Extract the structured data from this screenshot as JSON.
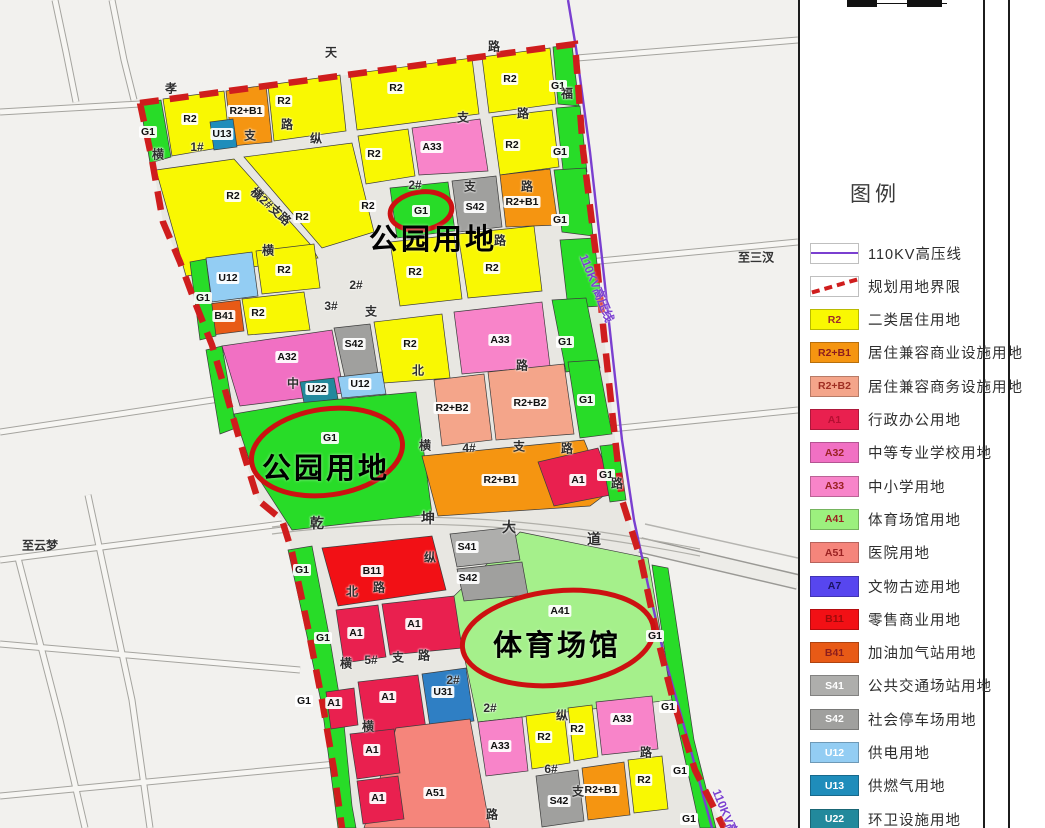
{
  "legend": {
    "title": "图例",
    "items": [
      {
        "type": "line110",
        "code": "",
        "label": "110KV高压线"
      },
      {
        "type": "dash",
        "code": "",
        "label": "规划用地界限"
      },
      {
        "type": "fill",
        "code": "R2",
        "color": "#f9f802",
        "code_color": "#9e2b2b",
        "label": "二类居住用地"
      },
      {
        "type": "fill",
        "code": "R2+B1",
        "color": "#f59511",
        "code_color": "#8d1d1d",
        "label": "居住兼容商业设施用地"
      },
      {
        "type": "fill",
        "code": "R2+B2",
        "color": "#f4a58a",
        "code_color": "#a03024",
        "label": "居住兼容商务设施用地"
      },
      {
        "type": "fill",
        "code": "A1",
        "color": "#e9204f",
        "code_color": "#b50f32",
        "label": "行政办公用地"
      },
      {
        "type": "fill",
        "code": "A32",
        "color": "#f170c3",
        "code_color": "#9b2222",
        "label": "中等专业学校用地"
      },
      {
        "type": "fill",
        "code": "A33",
        "color": "#f884c9",
        "code_color": "#9b2222",
        "label": "中小学用地"
      },
      {
        "type": "fill",
        "code": "A41",
        "color": "#9cf07e",
        "code_color": "#9b2222",
        "label": "体育场馆用地"
      },
      {
        "type": "fill",
        "code": "A51",
        "color": "#f5857b",
        "code_color": "#9b2222",
        "label": "医院用地"
      },
      {
        "type": "fill",
        "code": "A7",
        "color": "#5746ef",
        "code_color": "#1b1464",
        "label": "文物古迹用地"
      },
      {
        "type": "fill",
        "code": "B11",
        "color": "#f21015",
        "code_color": "#9e0a0a",
        "label": "零售商业用地"
      },
      {
        "type": "fill",
        "code": "B41",
        "color": "#e85a16",
        "code_color": "#8d1d1d",
        "label": "加油加气站用地"
      },
      {
        "type": "fill",
        "code": "S41",
        "color": "#aeaeac",
        "code_color": "#ffffff",
        "label": "公共交通场站用地"
      },
      {
        "type": "fill",
        "code": "S42",
        "color": "#a0a09e",
        "code_color": "#ffffff",
        "label": "社会停车场用地"
      },
      {
        "type": "fill",
        "code": "U12",
        "color": "#93cdf3",
        "code_color": "#ffffff",
        "label": "供电用地"
      },
      {
        "type": "fill",
        "code": "U13",
        "color": "#1f8dbb",
        "code_color": "#ffffff",
        "label": "供燃气用地"
      },
      {
        "type": "fill",
        "code": "U22",
        "color": "#22899c",
        "code_color": "#ffffff",
        "label": "环卫设施用地"
      }
    ]
  },
  "map": {
    "boundary_color": "#cf1d1d",
    "power_line_color": "#7a3fd0",
    "annotations": [
      {
        "t": "公园用地",
        "x": 433,
        "y": 237
      },
      {
        "t": "公园用地",
        "x": 326,
        "y": 466
      },
      {
        "t": "体育场馆",
        "x": 557,
        "y": 643
      }
    ],
    "notes": [
      {
        "t": "至云梦",
        "x": 40,
        "y": 545
      },
      {
        "t": "至三汊",
        "x": 756,
        "y": 257
      },
      {
        "t": "110KV高压线",
        "x": 597,
        "y": 288,
        "r": 68,
        "c": "#7a3fd0"
      },
      {
        "t": "110KV高压线",
        "x": 730,
        "y": 823,
        "r": 68,
        "c": "#7a3fd0"
      }
    ],
    "parcel_labels": [
      {
        "t": "G1",
        "x": 148,
        "y": 132
      },
      {
        "t": "R2",
        "x": 190,
        "y": 119
      },
      {
        "t": "U13",
        "x": 222,
        "y": 134
      },
      {
        "t": "R2+B1",
        "x": 246,
        "y": 111
      },
      {
        "t": "R2",
        "x": 284,
        "y": 101
      },
      {
        "t": "R2",
        "x": 396,
        "y": 88
      },
      {
        "t": "R2",
        "x": 510,
        "y": 79
      },
      {
        "t": "G1",
        "x": 558,
        "y": 86
      },
      {
        "t": "R2",
        "x": 233,
        "y": 196
      },
      {
        "t": "R2",
        "x": 302,
        "y": 217
      },
      {
        "t": "R2",
        "x": 368,
        "y": 206
      },
      {
        "t": "R2",
        "x": 374,
        "y": 154
      },
      {
        "t": "A33",
        "x": 432,
        "y": 147
      },
      {
        "t": "R2",
        "x": 512,
        "y": 145
      },
      {
        "t": "G1",
        "x": 560,
        "y": 152
      },
      {
        "t": "G1",
        "x": 421,
        "y": 211
      },
      {
        "t": "S42",
        "x": 475,
        "y": 207
      },
      {
        "t": "R2+B1",
        "x": 522,
        "y": 202
      },
      {
        "t": "G1",
        "x": 560,
        "y": 220
      },
      {
        "t": "U12",
        "x": 228,
        "y": 278
      },
      {
        "t": "R2",
        "x": 284,
        "y": 270
      },
      {
        "t": "B41",
        "x": 224,
        "y": 316
      },
      {
        "t": "R2",
        "x": 258,
        "y": 313
      },
      {
        "t": "G1",
        "x": 203,
        "y": 298
      },
      {
        "t": "R2",
        "x": 415,
        "y": 272
      },
      {
        "t": "R2",
        "x": 492,
        "y": 268
      },
      {
        "t": "A32",
        "x": 287,
        "y": 357
      },
      {
        "t": "S42",
        "x": 354,
        "y": 344
      },
      {
        "t": "R2",
        "x": 410,
        "y": 344
      },
      {
        "t": "A33",
        "x": 500,
        "y": 340
      },
      {
        "t": "G1",
        "x": 565,
        "y": 342
      },
      {
        "t": "U22",
        "x": 317,
        "y": 389
      },
      {
        "t": "U12",
        "x": 360,
        "y": 384
      },
      {
        "t": "G1",
        "x": 330,
        "y": 438
      },
      {
        "t": "R2+B2",
        "x": 452,
        "y": 408
      },
      {
        "t": "R2+B2",
        "x": 530,
        "y": 403
      },
      {
        "t": "G1",
        "x": 586,
        "y": 400
      },
      {
        "t": "R2+B1",
        "x": 500,
        "y": 480
      },
      {
        "t": "A1",
        "x": 578,
        "y": 480
      },
      {
        "t": "G1",
        "x": 606,
        "y": 475
      },
      {
        "t": "G1",
        "x": 302,
        "y": 570
      },
      {
        "t": "B11",
        "x": 372,
        "y": 571
      },
      {
        "t": "S41",
        "x": 467,
        "y": 547
      },
      {
        "t": "S42",
        "x": 468,
        "y": 578
      },
      {
        "t": "A41",
        "x": 560,
        "y": 611
      },
      {
        "t": "G1",
        "x": 323,
        "y": 638
      },
      {
        "t": "A1",
        "x": 356,
        "y": 633
      },
      {
        "t": "A1",
        "x": 414,
        "y": 624
      },
      {
        "t": "G1",
        "x": 304,
        "y": 701
      },
      {
        "t": "A1",
        "x": 334,
        "y": 703
      },
      {
        "t": "A1",
        "x": 388,
        "y": 697
      },
      {
        "t": "U31",
        "x": 443,
        "y": 692
      },
      {
        "t": "A1",
        "x": 372,
        "y": 750
      },
      {
        "t": "A1",
        "x": 378,
        "y": 798
      },
      {
        "t": "A51",
        "x": 435,
        "y": 793
      },
      {
        "t": "A33",
        "x": 500,
        "y": 746
      },
      {
        "t": "R2",
        "x": 544,
        "y": 737
      },
      {
        "t": "R2",
        "x": 577,
        "y": 729
      },
      {
        "t": "A33",
        "x": 622,
        "y": 719
      },
      {
        "t": "G1",
        "x": 655,
        "y": 636
      },
      {
        "t": "G1",
        "x": 668,
        "y": 707
      },
      {
        "t": "G1",
        "x": 680,
        "y": 771
      },
      {
        "t": "G1",
        "x": 689,
        "y": 819
      },
      {
        "t": "S42",
        "x": 559,
        "y": 801
      },
      {
        "t": "R2+B1",
        "x": 601,
        "y": 790
      },
      {
        "t": "R2",
        "x": 644,
        "y": 780
      }
    ],
    "road_labels": [
      {
        "t": "天",
        "x": 331,
        "y": 52
      },
      {
        "t": "路",
        "x": 494,
        "y": 46
      },
      {
        "t": "孝",
        "x": 171,
        "y": 88
      },
      {
        "t": "横",
        "x": 158,
        "y": 154
      },
      {
        "t": "1#",
        "x": 197,
        "y": 147
      },
      {
        "t": "支",
        "x": 250,
        "y": 135
      },
      {
        "t": "路",
        "x": 287,
        "y": 124
      },
      {
        "t": "支",
        "x": 463,
        "y": 117
      },
      {
        "t": "路",
        "x": 523,
        "y": 113
      },
      {
        "t": "纵",
        "x": 316,
        "y": 138
      },
      {
        "t": "福",
        "x": 567,
        "y": 93
      },
      {
        "t": "横2#支路",
        "x": 271,
        "y": 206,
        "r": 42
      },
      {
        "t": "2#",
        "x": 415,
        "y": 185
      },
      {
        "t": "支",
        "x": 470,
        "y": 186
      },
      {
        "t": "路",
        "x": 527,
        "y": 186
      },
      {
        "t": "横",
        "x": 268,
        "y": 250
      },
      {
        "t": "2#",
        "x": 356,
        "y": 285
      },
      {
        "t": "3#",
        "x": 331,
        "y": 306
      },
      {
        "t": "支",
        "x": 371,
        "y": 311
      },
      {
        "t": "路",
        "x": 500,
        "y": 240
      },
      {
        "t": "中",
        "x": 293,
        "y": 383
      },
      {
        "t": "北",
        "x": 418,
        "y": 370
      },
      {
        "t": "路",
        "x": 522,
        "y": 365
      },
      {
        "t": "横",
        "x": 425,
        "y": 445
      },
      {
        "t": "4#",
        "x": 469,
        "y": 448
      },
      {
        "t": "支",
        "x": 519,
        "y": 446
      },
      {
        "t": "路",
        "x": 567,
        "y": 448
      },
      {
        "t": "路",
        "x": 617,
        "y": 483
      },
      {
        "t": "乾",
        "x": 317,
        "y": 523,
        "s": 14
      },
      {
        "t": "坤",
        "x": 428,
        "y": 518,
        "s": 14
      },
      {
        "t": "大",
        "x": 509,
        "y": 527,
        "s": 14
      },
      {
        "t": "道",
        "x": 594,
        "y": 539,
        "s": 14
      },
      {
        "t": "纵",
        "x": 430,
        "y": 557
      },
      {
        "t": "北",
        "x": 352,
        "y": 591
      },
      {
        "t": "路",
        "x": 379,
        "y": 587
      },
      {
        "t": "横",
        "x": 346,
        "y": 663
      },
      {
        "t": "5#",
        "x": 371,
        "y": 660
      },
      {
        "t": "支",
        "x": 398,
        "y": 657
      },
      {
        "t": "路",
        "x": 424,
        "y": 655
      },
      {
        "t": "2#",
        "x": 453,
        "y": 680
      },
      {
        "t": "2#",
        "x": 490,
        "y": 708
      },
      {
        "t": "横",
        "x": 368,
        "y": 726
      },
      {
        "t": "纵",
        "x": 562,
        "y": 715
      },
      {
        "t": "6#",
        "x": 551,
        "y": 769
      },
      {
        "t": "支",
        "x": 578,
        "y": 791
      },
      {
        "t": "路",
        "x": 492,
        "y": 814
      },
      {
        "t": "路",
        "x": 646,
        "y": 752
      }
    ]
  }
}
